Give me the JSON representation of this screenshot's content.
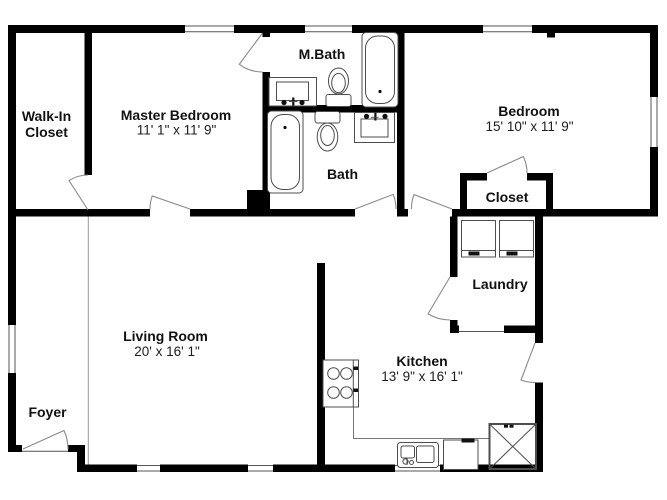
{
  "colors": {
    "wall": "#000000",
    "background": "#ffffff",
    "fixture": "#4d4d4d",
    "door": "#8a8a8a",
    "divider": "#9a9a9a",
    "window_line": "#555555"
  },
  "rooms": {
    "walk_in_closet": {
      "name_line1": "Walk-In",
      "name_line2": "Closet"
    },
    "master_bedroom": {
      "name": "Master Bedroom",
      "dims": "11' 1\" x 11' 9\""
    },
    "m_bath": {
      "name": "M.Bath"
    },
    "bath": {
      "name": "Bath"
    },
    "bedroom": {
      "name": "Bedroom",
      "dims": "15' 10\" x 11' 9\""
    },
    "closet": {
      "name": "Closet"
    },
    "laundry": {
      "name": "Laundry"
    },
    "living_room": {
      "name": "Living Room",
      "dims": "20' x 16' 1\""
    },
    "kitchen": {
      "name": "Kitchen",
      "dims": "13' 9\" x 16' 1\""
    },
    "foyer": {
      "name": "Foyer"
    }
  },
  "fixtures": {
    "m_bath": [
      "vanity-sink",
      "toilet",
      "bathtub"
    ],
    "bath": [
      "bathtub",
      "toilet",
      "vanity-sink"
    ],
    "laundry": [
      "washer",
      "dryer"
    ],
    "kitchen": [
      "stove",
      "counter",
      "sink",
      "dishwasher",
      "refrigerator"
    ]
  }
}
